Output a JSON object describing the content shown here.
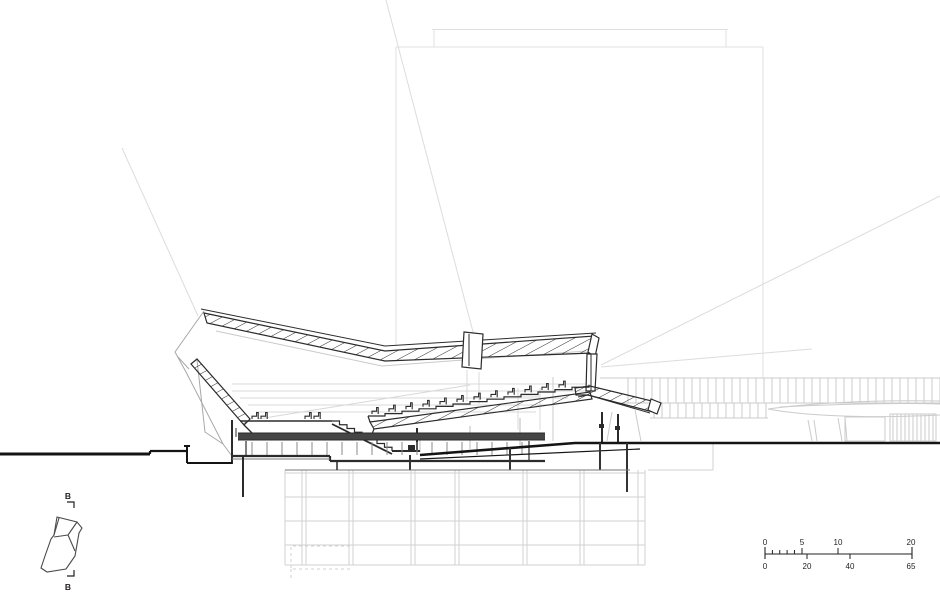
{
  "document": {
    "type": "architectural-section-drawing",
    "background": "#ffffff"
  },
  "key_plan": {
    "section_label_top": "B",
    "section_label_bottom": "B"
  },
  "scale_bar": {
    "meters_labels": [
      "0",
      "5",
      "10",
      "20"
    ],
    "feet_labels": [
      "0",
      "20",
      "40",
      "65"
    ]
  },
  "colors": {
    "ink": "#2b2b2b",
    "ground": "#141414",
    "medium_gray": "#9a9a9a",
    "light_gray": "#cdcdcd",
    "faint_gray": "#e0e0e0",
    "text": "#231f20"
  }
}
